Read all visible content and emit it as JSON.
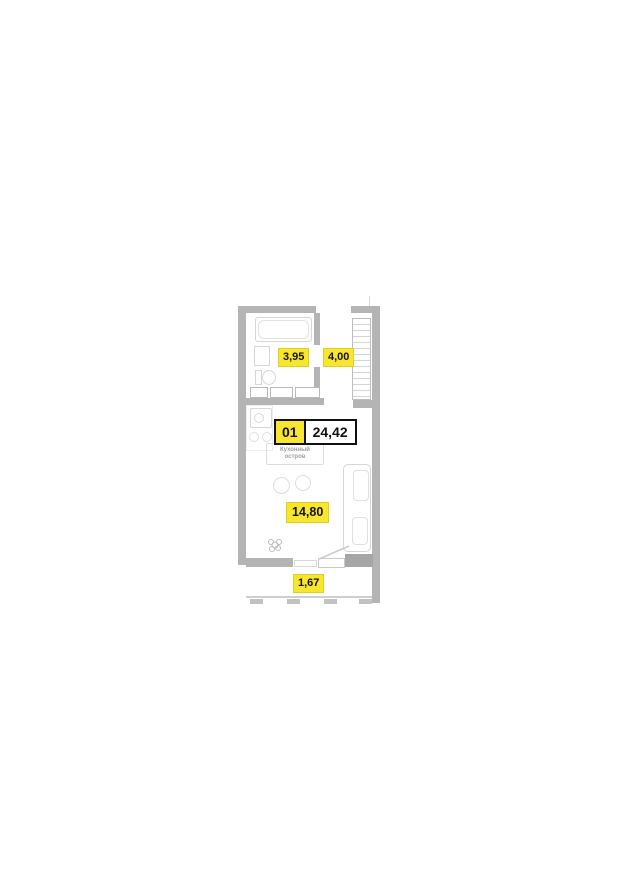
{
  "floor_plan": {
    "unit": {
      "number": "01",
      "total_area": "24,42"
    },
    "areas": {
      "bathroom": "3,95",
      "hallway": "4,00",
      "living_room": "14,80",
      "balcony": "1,67"
    },
    "labels": {
      "kitchen_island": "Кухонный остров"
    },
    "colors": {
      "label_yellow": "#F7E52E",
      "wall_gray": "#B4B4B4",
      "wall_dark_gray": "#A6A6A6",
      "fixture_outline": "#D6D6D6",
      "text_black": "#141414",
      "muted_text": "#A0A0A0"
    }
  }
}
